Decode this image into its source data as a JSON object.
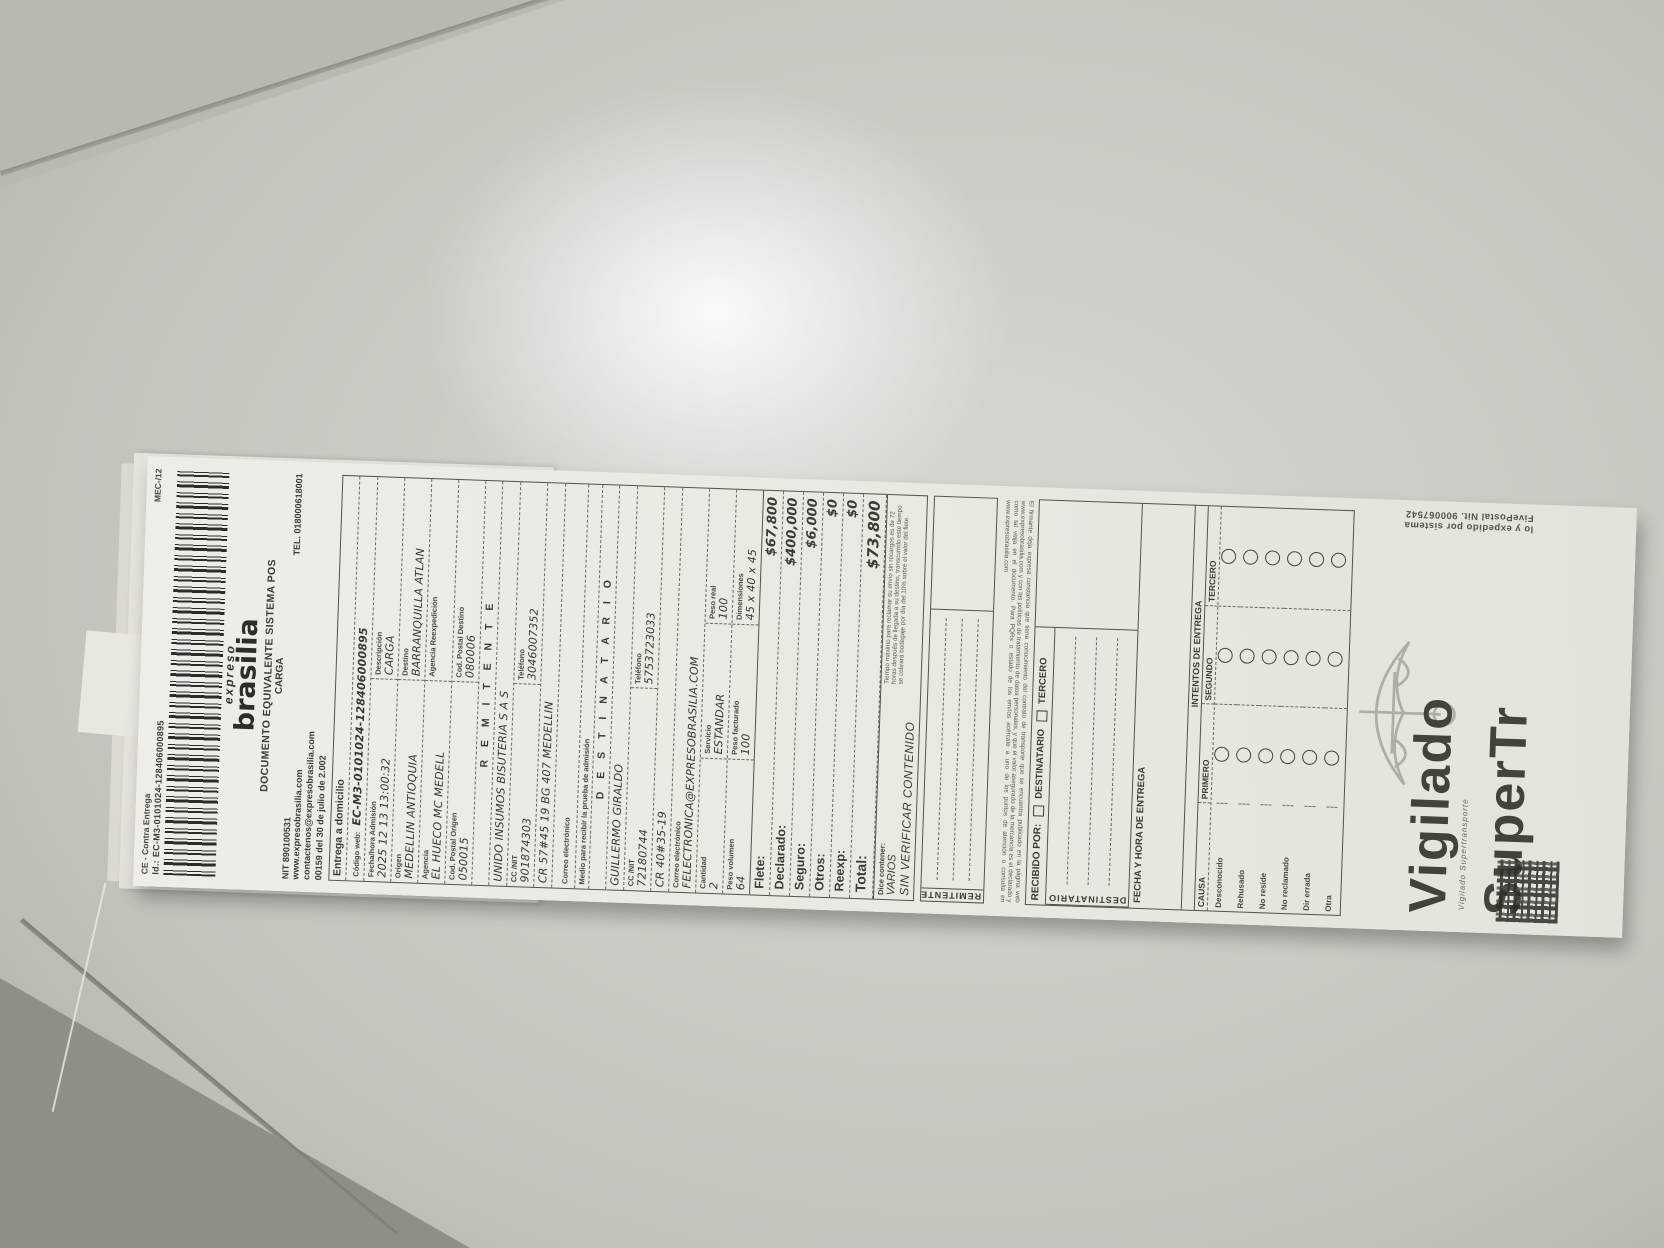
{
  "stub": {
    "ce_label": "CE - Contra Entrega",
    "mec": "MEC-/12",
    "id_line": "Id.: EC-M3-0101024-128406000895"
  },
  "brand": {
    "script": "expreso",
    "name": "brasilia",
    "title": "DOCUMENTO EQUIVALENTE SISTEMA POS",
    "subtitle": "CARGA",
    "nit": "NIT 890100531",
    "tel": "TEL. 018000618001",
    "web": "www.expresobrasilia.com",
    "email": "contactenos@expresobrasilia.com",
    "resolution": "00159 del 30 de julio de 2.002"
  },
  "info": {
    "entrega": "Entrega a domicilio",
    "codigo_web_label": "Código web:",
    "codigo_web": "EC-M3-0101024-128406000895",
    "fecha_label": "Fecha/hora Admisión",
    "fecha": "2025 12 13 13:00:32",
    "descripcion_label": "Descripción",
    "descripcion": "CARGA",
    "origen_label": "Origen",
    "origen": "MEDELLIN ANTIOQUIA",
    "destino_label": "Destino",
    "destino": "BARRANQUILLA ATLAN",
    "agencia_label": "Agencia",
    "agencia": "EL HUECO MC MEDELL",
    "agencia_reexp_label": "Agencia Reexpedición",
    "agencia_reexp": "",
    "cp_origen_label": "Cod. Postal Origen",
    "cp_origen": "050015",
    "cp_destino_label": "Cod. Postal Destino",
    "cp_destino": "080006"
  },
  "remitente": {
    "title": "R E M I T E N T E",
    "nombre": "UNIDO INSUMOS BISUTERIA S A S",
    "ccnit_label": "CC /NIT",
    "ccnit": "901874303",
    "tel_label": "Teléfono",
    "tel": "3046007352",
    "direccion": "CR 57#45 19 BG 407 MEDELLIN",
    "correo_label": "Correo electrónico",
    "correo": "",
    "medio_label": "Medio para recibir la prueba de admisión"
  },
  "destinatario": {
    "title": "D E S T I N A T A R I O",
    "nombre": "GUILLERMO GIRALDO",
    "ccnit_label": "CC /NIT",
    "ccnit": "72180744",
    "tel_label": "Teléfono",
    "tel": "5753723033",
    "direccion": "CR 40#35-19",
    "correo_label": "Correo electrónico",
    "correo": "FELECTRONICA@EXPRESOBRASILIA.COM"
  },
  "envio": {
    "cantidad_label": "Cantidad",
    "cantidad": "2",
    "servicio_label": "Servicio",
    "servicio": "ESTANDAR",
    "peso_real_label": "Peso real",
    "peso_real": "100",
    "peso_vol_label": "Peso volumen",
    "peso_vol": "64",
    "peso_fact_label": "Peso facturado",
    "peso_fact": "100",
    "dim_label": "Dimensiones",
    "dim": "45 x 40 x 45"
  },
  "charges": {
    "items": [
      {
        "label": "Flete:",
        "value": "$67,800",
        "total": false
      },
      {
        "label": "Declarado:",
        "value": "$400,000",
        "total": false
      },
      {
        "label": "Seguro:",
        "value": "$6,000",
        "total": false
      },
      {
        "label": "Otros:",
        "value": "$0",
        "total": false
      },
      {
        "label": "Reexp:",
        "value": "$0",
        "total": false
      },
      {
        "label": "Total:",
        "value": "$73,800",
        "total": true
      }
    ]
  },
  "contenido": {
    "label": "Dice contener:",
    "value": "VARIOS",
    "verify": "SIN VERIFICAR CONTENIDO",
    "fineprint": "Tiempo máximo para reclamar su envío sin recargos es de 72 horas después de llegada a su destino, transcurrido este tiempo se cobrará bodegaje por día del 10% sobre el valor del flete."
  },
  "firmas": {
    "remitente": "REMITENTE",
    "destinatario": "DESTINATARIO"
  },
  "contrato": "El firmante deja expresa constancia que tiene conocimiento del contrato de transporte que se encuentra publicado en la página web www.expresobrasilia.com y con las políticas de tratamiento de datos personales, y que el valor asegurado de la mercancía es el declarado y como tal viaja en el documento. Para PQRs o estado de los envíos acércate a uno de los puntos de atención o consulta en www.expresobrasilia.com",
  "entrega_final": {
    "recibido_label": "RECIBIDO POR:",
    "op1": "DESTINATARIO",
    "op2": "TERCERO",
    "fecha_label": "FECHA Y HORA DE ENTREGA",
    "intentos_title": "INTENTOS DE ENTREGA",
    "causa_label": "CAUSA",
    "columnas": [
      "PRIMERO",
      "SEGUNDO",
      "TERCERO"
    ],
    "causas": [
      "Desconocido",
      "Rehusado",
      "No reside",
      "No reclamado",
      "Dir errada",
      "Otra"
    ]
  },
  "footer": {
    "vigilado": "Vigilado",
    "supertr": "SuperTr",
    "caption": "Vigilado Supertransporte",
    "fivepostal": "lo y expedido por sistema FivePostal Nit. 900067542"
  }
}
